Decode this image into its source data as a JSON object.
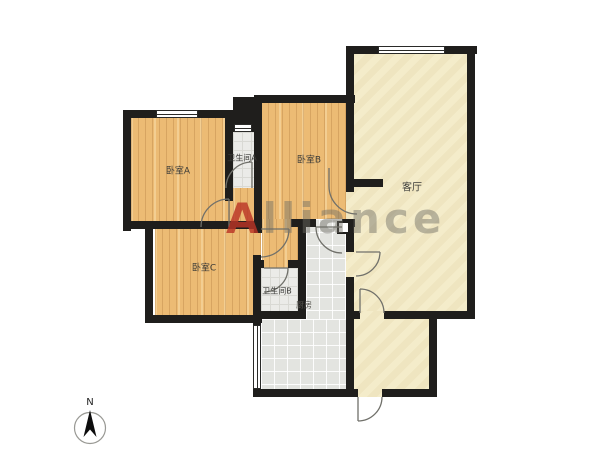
{
  "floorplan": {
    "rooms": [
      {
        "id": "bedroom-a",
        "label": "卧室A"
      },
      {
        "id": "bathroom-a",
        "label": "卫生间A"
      },
      {
        "id": "bedroom-b",
        "label": "卧室B"
      },
      {
        "id": "bedroom-c",
        "label": "卧室C"
      },
      {
        "id": "bathroom-b",
        "label": "卫生间B"
      },
      {
        "id": "kitchen",
        "label": "厨房"
      },
      {
        "id": "living-room",
        "label": "客厅"
      }
    ],
    "watermark": {
      "first_letter": "A",
      "rest": "lliance",
      "accent_color": "#bb3526",
      "text_color": "#6e6c64"
    },
    "compass": {
      "north_label": "N"
    },
    "colors": {
      "wall": "#1f1e1c",
      "wood_floor": "#ecbb74",
      "bathroom_tile": "#ebebe8",
      "kitchen_tile": "#e3e4e0",
      "living_floor": "#f4ecca",
      "door_arc": "#70706a",
      "background": "#ffffff"
    }
  }
}
